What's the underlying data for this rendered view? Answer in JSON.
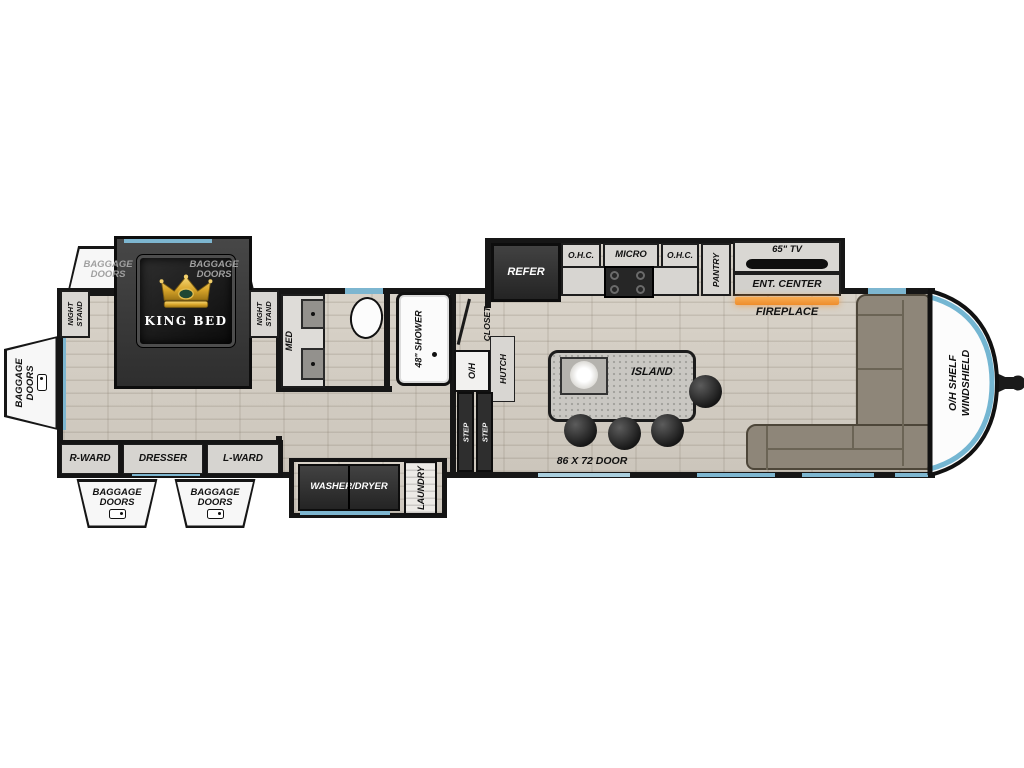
{
  "title": "Travel trailer floor plan",
  "labels": {
    "bedroom": {
      "baggage_doors_top_left": "BAGGAGE DOORS",
      "baggage_doors_top_right": "BAGGAGE DOORS",
      "baggage_doors_side": "BAGGAGE DOORS",
      "baggage_doors_bottom_left": "BAGGAGE DOORS",
      "baggage_doors_bottom_right": "BAGGAGE DOORS",
      "night_stand_left": "NIGHT STAND",
      "night_stand_right": "NIGHT STAND",
      "king_bed": "KING BED",
      "r_ward": "R-WARD",
      "dresser": "DRESSER",
      "l_ward": "L-WARD"
    },
    "bath": {
      "med": "MED",
      "shower": "48\" SHOWER",
      "closet": "CLOSET",
      "overhead": "O/H",
      "hutch": "HUTCH",
      "step_1": "STEP",
      "step_2": "STEP"
    },
    "utility": {
      "washer_dryer": "WASHER/DRYER",
      "laundry": "LAUNDRY"
    },
    "kitchen": {
      "refer": "REFER",
      "ohc_left": "O.H.C.",
      "micro": "MICRO",
      "ohc_right": "O.H.C.",
      "pantry": "PANTRY",
      "island": "ISLAND",
      "entry_door": "86 X 72 DOOR"
    },
    "living": {
      "tv": "65\" TV",
      "ent_center": "ENT. CENTER",
      "fireplace": "FIREPLACE",
      "front_shelf_line1": "O/H SHELF",
      "front_shelf_line2": "WINDSHIELD"
    }
  },
  "icons": {
    "crown": "king-crown",
    "baggage_hatch": "baggage-door-hatch",
    "propane": "propane-tanks",
    "hitch": "a-frame-hitch"
  },
  "colors": {
    "accent_blue": "#7db6d0",
    "fireplace_orange": "#f49b3f",
    "sofa_taupe": "#8e8679",
    "floor_beige": "#d3cdc3",
    "slide_dark": "#3a3a3a",
    "crown_gold": "#d4a017"
  }
}
